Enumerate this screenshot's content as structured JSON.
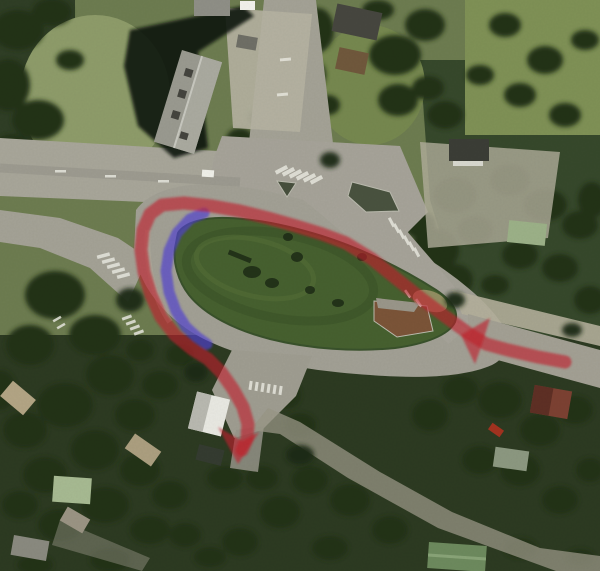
{
  "scene": {
    "palette": {
      "asphalt": "#a6a399",
      "gravel_shoulder": "#b4af9b",
      "field_grass": "#8c9a66",
      "island_grass": "#46602f",
      "tree_canopy_dark": "#223019",
      "building_roof_gray": "#9a9a90",
      "crosswalk_white": "#e9e9e0",
      "paved_divider_brown": "#7b5438"
    }
  },
  "overlay": {
    "red_route": {
      "color": "#c2202c",
      "opacity": 0.62,
      "stroke_width": 13,
      "points": [
        [
          565,
          362
        ],
        [
          538,
          357
        ],
        [
          508,
          350
        ],
        [
          486,
          344
        ],
        [
          468,
          333
        ],
        [
          446,
          317
        ],
        [
          422,
          299
        ],
        [
          398,
          280
        ],
        [
          372,
          259
        ],
        [
          346,
          243
        ],
        [
          322,
          234
        ],
        [
          296,
          226
        ],
        [
          268,
          218
        ],
        [
          240,
          211
        ],
        [
          212,
          206
        ],
        [
          184,
          203
        ],
        [
          162,
          205
        ],
        [
          150,
          214
        ],
        [
          143,
          230
        ],
        [
          141,
          250
        ],
        [
          144,
          272
        ],
        [
          151,
          295
        ],
        [
          161,
          317
        ],
        [
          175,
          335
        ],
        [
          192,
          349
        ],
        [
          208,
          359
        ],
        [
          221,
          372
        ],
        [
          233,
          389
        ],
        [
          243,
          407
        ],
        [
          248,
          424
        ],
        [
          247,
          439
        ],
        [
          242,
          450
        ]
      ],
      "arrowheads": [
        [
          [
            461,
            335
          ],
          [
            490,
            318
          ],
          [
            483,
            341
          ],
          [
            475,
            364
          ]
        ],
        [
          [
            238,
            464
          ],
          [
            259,
            432
          ],
          [
            242,
            441
          ],
          [
            218,
            427
          ]
        ]
      ]
    },
    "blue_route": {
      "color": "#5140d2",
      "opacity": 0.68,
      "stroke_width": 11,
      "points": [
        [
          204,
          213
        ],
        [
          190,
          219
        ],
        [
          177,
          233
        ],
        [
          169,
          251
        ],
        [
          166,
          271
        ],
        [
          169,
          292
        ],
        [
          176,
          311
        ],
        [
          186,
          327
        ],
        [
          197,
          337
        ],
        [
          207,
          344
        ]
      ]
    }
  }
}
